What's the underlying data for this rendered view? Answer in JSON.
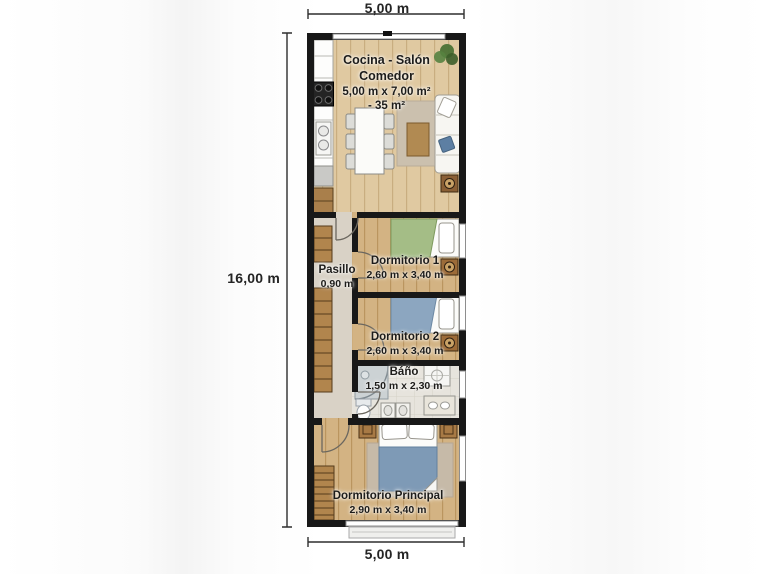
{
  "title": "Floor plan",
  "dimensions": {
    "top": "5,00 m",
    "left": "16,00 m",
    "bottom": "5,00 m"
  },
  "rooms": {
    "living": {
      "name": "Cocina - Salón Comedor",
      "size": "5,00 m x 7,00 m²",
      "area": "- 35 m²"
    },
    "hallway": {
      "name": "Pasillo",
      "size": "0,90 m"
    },
    "bedroom1": {
      "name": "Dormitorio 1",
      "size": "2,60 m x 3,40 m"
    },
    "bedroom2": {
      "name": "Dormitorio 2",
      "size": "2,60 m x 3,40 m"
    },
    "bathroom": {
      "name": "Báño",
      "size": "1,50 m x 2,30 m"
    },
    "master": {
      "name": "Dormitorio Principal",
      "size": "2,90 m x 3,40 m"
    }
  },
  "colors": {
    "wall": "#181818",
    "wood-light": "#e0c9a1",
    "wood-mid": "#d3b383",
    "hall-floor": "#d9d2c6",
    "tile": "#e7e4dd",
    "blanket-green": "#a4bd86",
    "blanket-blue": "#8ca6c0",
    "blanket-master": "#7e9ab6",
    "cabinet-wood": "#b1854d",
    "dim-line": "#2f2f2f"
  }
}
